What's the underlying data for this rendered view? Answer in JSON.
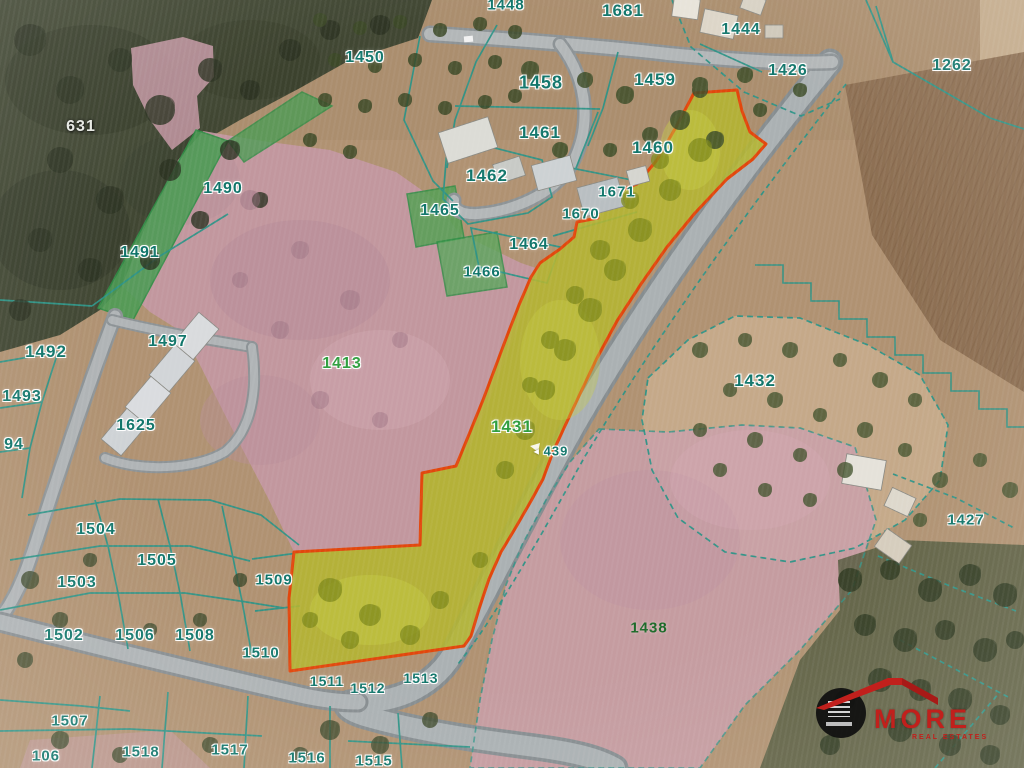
{
  "map": {
    "type": "cadastral-satellite",
    "highlighted_parcels": [
      "1431",
      "439"
    ],
    "highlight_fill": "#b4b531",
    "highlight_border": "#e2470c",
    "boundary_color": "#2e9487",
    "label_colors": {
      "teal": "#10756a",
      "green": "#2f9e3e",
      "darkgreen": "#1d6b2a",
      "white": "#e6e8e2"
    },
    "labels": [
      {
        "id": "631",
        "x": 81,
        "y": 127,
        "c": "white",
        "s": 16
      },
      {
        "id": "1490",
        "x": 223,
        "y": 189,
        "c": "teal",
        "s": 16
      },
      {
        "id": "1491",
        "x": 140,
        "y": 253,
        "c": "teal",
        "s": 16
      },
      {
        "id": "1492",
        "x": 46,
        "y": 352,
        "c": "teal",
        "s": 17
      },
      {
        "id": "1493",
        "x": 22,
        "y": 397,
        "c": "teal",
        "s": 16
      },
      {
        "id": "94",
        "x": 14,
        "y": 445,
        "c": "teal",
        "s": 16
      },
      {
        "id": "1497",
        "x": 168,
        "y": 342,
        "c": "teal",
        "s": 16
      },
      {
        "id": "1625",
        "x": 136,
        "y": 426,
        "c": "teal",
        "s": 16
      },
      {
        "id": "1450",
        "x": 365,
        "y": 58,
        "c": "teal",
        "s": 16
      },
      {
        "id": "1448",
        "x": 506,
        "y": 5,
        "c": "teal",
        "s": 15
      },
      {
        "id": "1681",
        "x": 623,
        "y": 11,
        "c": "teal",
        "s": 17
      },
      {
        "id": "1458",
        "x": 541,
        "y": 83,
        "c": "teal",
        "s": 18
      },
      {
        "id": "1459",
        "x": 655,
        "y": 80,
        "c": "teal",
        "s": 17
      },
      {
        "id": "1461",
        "x": 540,
        "y": 133,
        "c": "teal",
        "s": 17
      },
      {
        "id": "1460",
        "x": 653,
        "y": 148,
        "c": "teal",
        "s": 17
      },
      {
        "id": "1462",
        "x": 487,
        "y": 176,
        "c": "teal",
        "s": 17
      },
      {
        "id": "1465",
        "x": 440,
        "y": 211,
        "c": "teal",
        "s": 16
      },
      {
        "id": "1671",
        "x": 617,
        "y": 192,
        "c": "teal",
        "s": 15
      },
      {
        "id": "1670",
        "x": 581,
        "y": 214,
        "c": "teal",
        "s": 15
      },
      {
        "id": "1464",
        "x": 529,
        "y": 245,
        "c": "teal",
        "s": 16
      },
      {
        "id": "1466",
        "x": 482,
        "y": 272,
        "c": "teal",
        "s": 15
      },
      {
        "id": "1444",
        "x": 741,
        "y": 30,
        "c": "teal",
        "s": 16
      },
      {
        "id": "1426",
        "x": 788,
        "y": 71,
        "c": "teal",
        "s": 16
      },
      {
        "id": "1262",
        "x": 952,
        "y": 66,
        "c": "teal",
        "s": 16
      },
      {
        "id": "1413",
        "x": 342,
        "y": 364,
        "c": "green",
        "s": 16
      },
      {
        "id": "1432",
        "x": 755,
        "y": 381,
        "c": "teal",
        "s": 17
      },
      {
        "id": "1431",
        "x": 512,
        "y": 427,
        "c": "green",
        "s": 17
      },
      {
        "id": "439",
        "x": 550,
        "y": 451,
        "c": "teal",
        "s": 13,
        "arrow": true
      },
      {
        "id": "1427",
        "x": 966,
        "y": 520,
        "c": "teal",
        "s": 15
      },
      {
        "id": "1438",
        "x": 649,
        "y": 628,
        "c": "darkgreen",
        "s": 15
      },
      {
        "id": "1504",
        "x": 96,
        "y": 530,
        "c": "teal",
        "s": 16
      },
      {
        "id": "1505",
        "x": 157,
        "y": 561,
        "c": "teal",
        "s": 16
      },
      {
        "id": "1503",
        "x": 77,
        "y": 583,
        "c": "teal",
        "s": 16
      },
      {
        "id": "1502",
        "x": 64,
        "y": 636,
        "c": "teal",
        "s": 16
      },
      {
        "id": "1506",
        "x": 135,
        "y": 636,
        "c": "teal",
        "s": 16
      },
      {
        "id": "1508",
        "x": 195,
        "y": 636,
        "c": "teal",
        "s": 16
      },
      {
        "id": "1509",
        "x": 274,
        "y": 580,
        "c": "teal",
        "s": 15
      },
      {
        "id": "1510",
        "x": 261,
        "y": 653,
        "c": "teal",
        "s": 15
      },
      {
        "id": "1507",
        "x": 70,
        "y": 721,
        "c": "teal",
        "s": 15
      },
      {
        "id": "106",
        "x": 46,
        "y": 756,
        "c": "teal",
        "s": 15
      },
      {
        "id": "1518",
        "x": 141,
        "y": 752,
        "c": "teal",
        "s": 15
      },
      {
        "id": "1517",
        "x": 230,
        "y": 750,
        "c": "teal",
        "s": 15
      },
      {
        "id": "1516",
        "x": 307,
        "y": 758,
        "c": "teal",
        "s": 15
      },
      {
        "id": "1515",
        "x": 374,
        "y": 761,
        "c": "teal",
        "s": 15
      },
      {
        "id": "1511",
        "x": 327,
        "y": 681,
        "c": "teal",
        "s": 14
      },
      {
        "id": "1512",
        "x": 368,
        "y": 688,
        "c": "teal",
        "s": 14
      },
      {
        "id": "1513",
        "x": 421,
        "y": 678,
        "c": "teal",
        "s": 14
      }
    ]
  },
  "logo": {
    "brand": "MORE",
    "tagline": "REAL ESTATES",
    "roof_color": "#c1201c"
  }
}
